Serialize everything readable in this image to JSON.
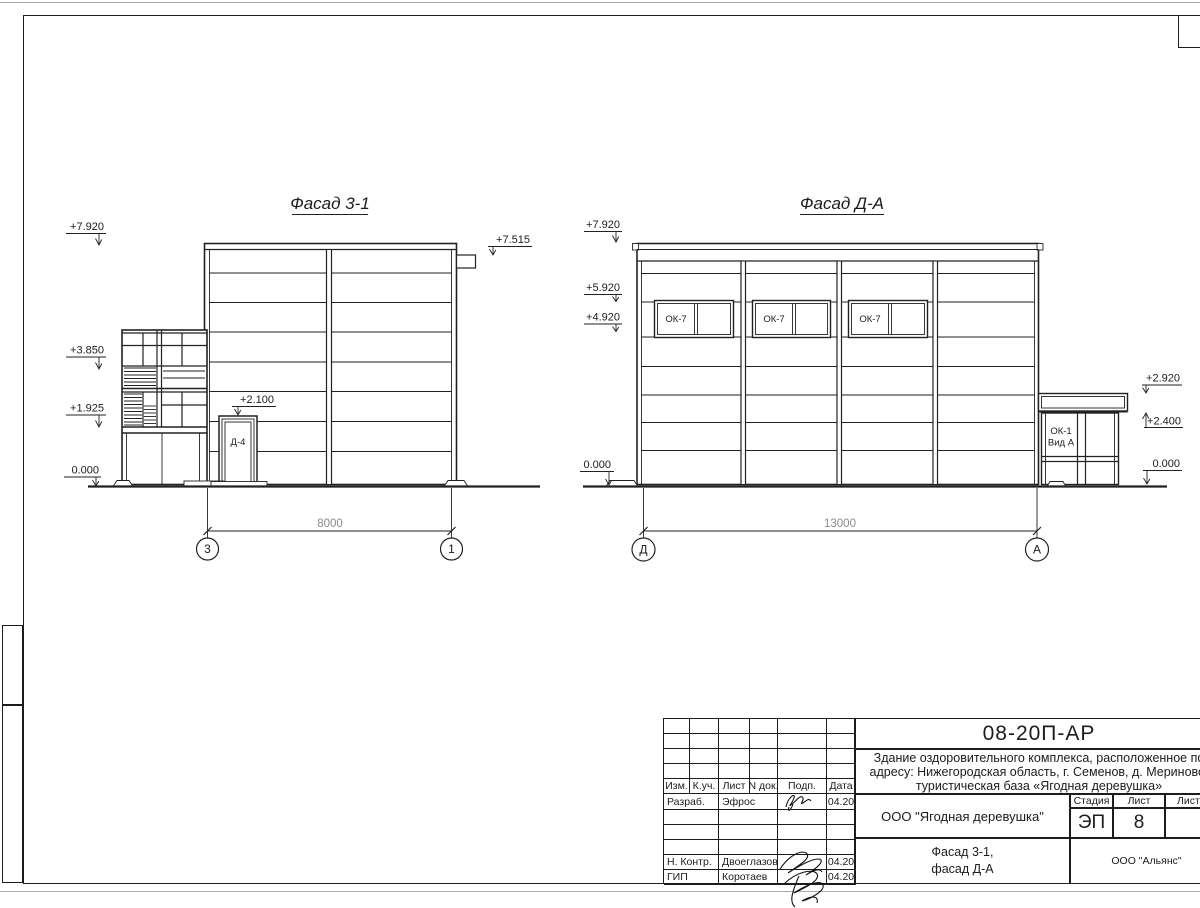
{
  "drawing": {
    "facade_left": {
      "title": "Фасад 3-1",
      "mark_7920": "+7.920",
      "mark_7515": "+7.515",
      "mark_3850": "+3.850",
      "mark_1925": "+1.925",
      "mark_0000": "0.000",
      "mark_2100": "+2.100",
      "door_label": "Д-4",
      "dim": "8000",
      "axis_left": "3",
      "axis_right": "1"
    },
    "facade_right": {
      "title": "Фасад Д-А",
      "mark_7920": "+7.920",
      "mark_5920": "+5.920",
      "mark_4920": "+4.920",
      "mark_2920": "+2.920",
      "mark_2400": "+2.400",
      "mark_0000_left": "0.000",
      "mark_0000_right": "0.000",
      "window_label": "ОК-7",
      "entry_label_1": "ОК-1",
      "entry_label_2": "Вид А",
      "dim": "13000",
      "axis_left": "Д",
      "axis_right": "А"
    }
  },
  "title_block": {
    "doc_number": "08-20П-АР",
    "description_line1": "Здание оздоровительного комплекса, расположенное по",
    "description_line2": "адресу: Нижегородская область, г. Семенов, д. Мериново,",
    "description_line3": "туристическая база «Ягодная деревушка»",
    "cols": {
      "izm": "Изм.",
      "kuch": "К.уч.",
      "list": "Лист",
      "ndok": "N док.",
      "podp": "Подп.",
      "data": "Дата"
    },
    "row_developer_role": "Разраб.",
    "row_developer_name": "Эфрос",
    "row_developer_date": "04.20",
    "row_ncontrol_role": "Н. Контр.",
    "row_ncontrol_name": "Двоеглазов",
    "row_ncontrol_date": "04.20",
    "row_gip_role": "ГИП",
    "row_gip_name": "Коротаев",
    "row_gip_date": "04.20",
    "org": "ООО \"Ягодная деревушка\"",
    "stage_label": "Стадия",
    "sheet_label": "Лист",
    "sheets_label": "Листов",
    "stage_value": "ЭП",
    "sheet_value": "8",
    "subtitle_1": "Фасад 3-1,",
    "subtitle_2": "фасад Д-А",
    "contractor": "ООО \"Альянс\""
  }
}
